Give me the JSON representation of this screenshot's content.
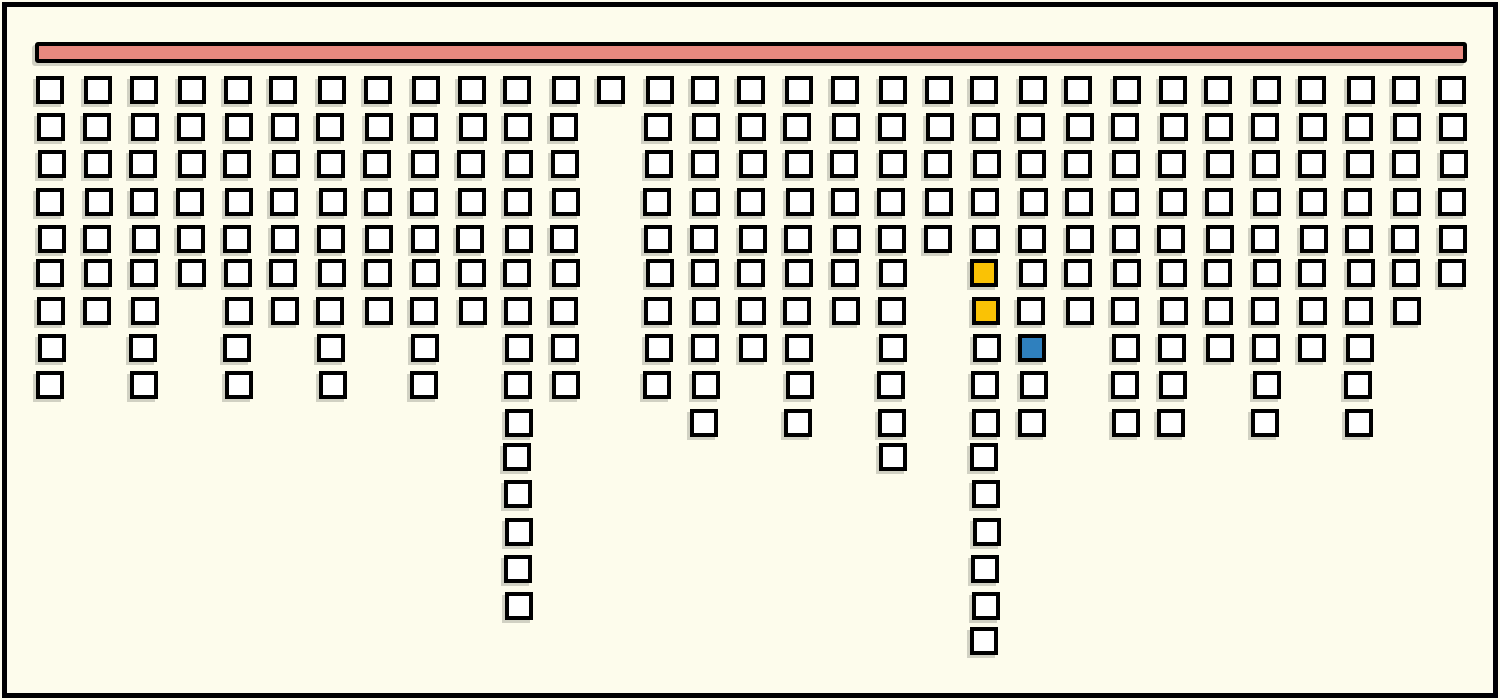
{
  "figure": {
    "title": "",
    "background_color": "#FDFCEC",
    "frame_color": "#000000",
    "top_bar_color": "#E8897F",
    "square_fill_color": "#FFFFFF",
    "square_border_color": "#000000",
    "gold_color": "#FAC205",
    "blue_color": "#2F80BE",
    "shadow_color": "rgba(110,110,100,0.30)"
  },
  "chart_data": {
    "type": "bar",
    "subtype": "unit-squares-hanging-from-top-bar",
    "title": "",
    "xlabel": "",
    "ylabel": "",
    "legend": [],
    "grid": false,
    "orientation": "columns hang downward from a horizontal salmon bar at the top",
    "columns_count": 31,
    "rows_max": 16,
    "categories": [
      1,
      2,
      3,
      4,
      5,
      6,
      7,
      8,
      9,
      10,
      11,
      12,
      13,
      14,
      15,
      16,
      17,
      18,
      19,
      20,
      21,
      22,
      23,
      24,
      25,
      26,
      27,
      28,
      29,
      30,
      31
    ],
    "values": [
      9,
      7,
      9,
      6,
      9,
      7,
      9,
      7,
      9,
      7,
      15,
      9,
      1,
      9,
      10,
      8,
      10,
      7,
      11,
      5,
      16,
      10,
      7,
      10,
      10,
      8,
      10,
      8,
      10,
      7,
      6
    ],
    "total_squares": 266,
    "highlighted_cells": [
      {
        "column_index": 20,
        "row_index": 5,
        "color_name": "gold",
        "color": "#FAC205"
      },
      {
        "column_index": 20,
        "row_index": 6,
        "color_name": "gold",
        "color": "#FAC205"
      },
      {
        "column_index": 21,
        "row_index": 7,
        "color_name": "blue",
        "color": "#2F80BE"
      }
    ],
    "default_cell_color_name": "white",
    "notes": "Column 13 (1-based) has a single square; columns 11 and 21 (1-based) are the longest stalactites."
  }
}
